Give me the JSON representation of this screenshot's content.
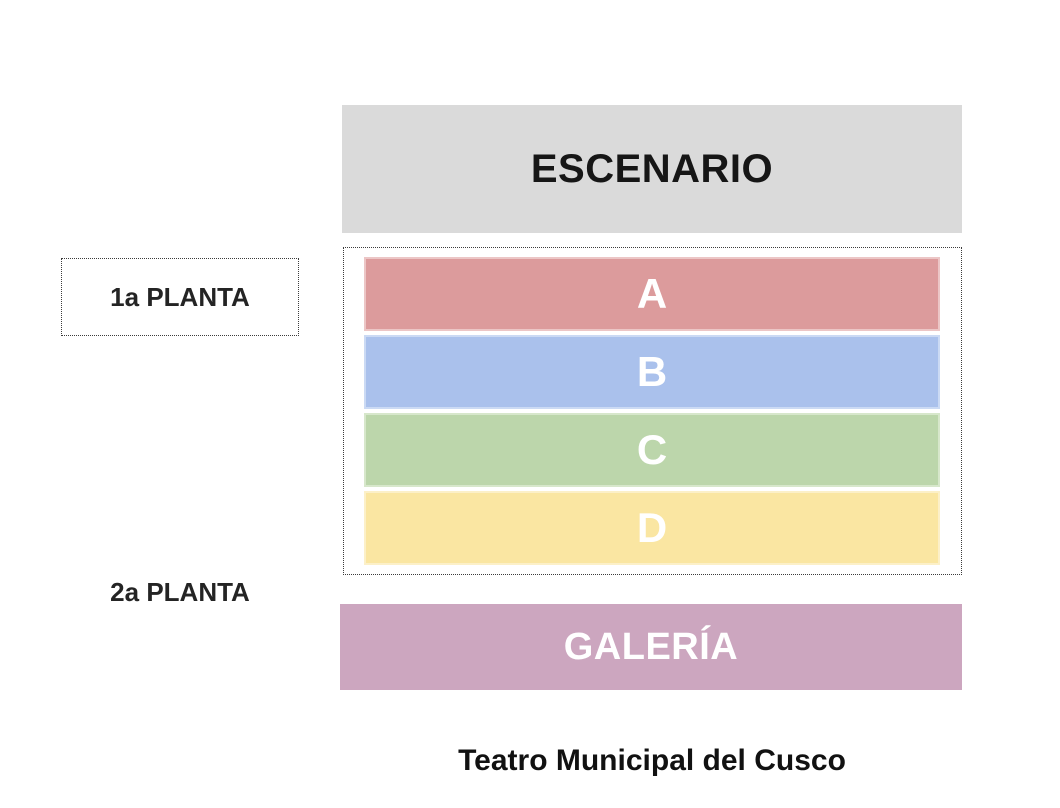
{
  "page": {
    "background": "#ffffff",
    "title": "Teatro Municipal del Cusco"
  },
  "stage": {
    "label": "ESCENARIO",
    "fill": "#dadada",
    "text_color": "#161616"
  },
  "floor_labels": [
    {
      "label": "1a PLANTA",
      "boxed": true
    },
    {
      "label": "2a PLANTA",
      "boxed": false
    }
  ],
  "sections": [
    {
      "label": "A",
      "fill": "#dc9b9c",
      "edge": "#ecc6c6"
    },
    {
      "label": "B",
      "fill": "#aac1ec",
      "edge": "#cbdaf4"
    },
    {
      "label": "C",
      "fill": "#bcd6ab",
      "edge": "#d7e7cb"
    },
    {
      "label": "D",
      "fill": "#fae6a2",
      "edge": "#fcf0c8"
    }
  ],
  "gallery": {
    "label": "GALERÍA",
    "fill": "#cca6bf",
    "text_color": "#ffffff"
  }
}
